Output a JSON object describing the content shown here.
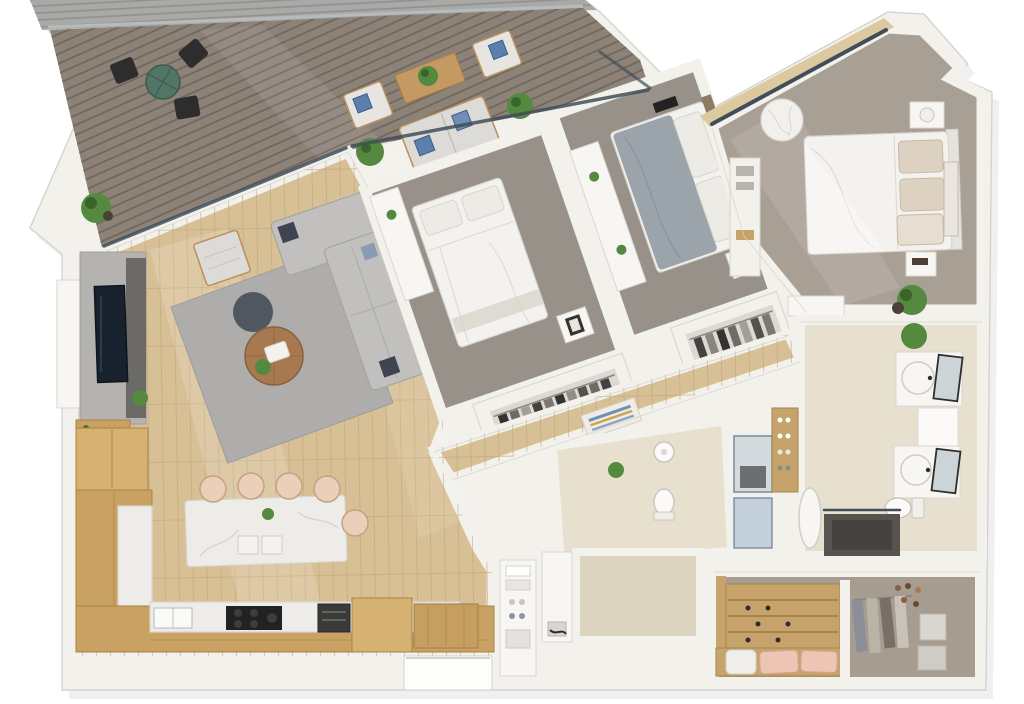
{
  "meta": {
    "kind": "3d-floor-plan-render",
    "view": "top-down dollhouse render of an apartment",
    "background": "#ffffff"
  },
  "colors": {
    "wall": "#f2f1ec",
    "wallEdge": "#d5d4cc",
    "shadow": "#000000",
    "roof": "#a9a9a7",
    "roofLine": "#8f8f8d",
    "deck": "#8d8278",
    "deckLine": "#6f655b",
    "deckRail": "#b6bcbe",
    "glass": "#414e59",
    "glassBlue": "#c3cfdb",
    "wood": "#d8c096",
    "woodLine": "#bfa276",
    "woodSill": "#dcc9a0",
    "cabinet": "#c9a263",
    "cabinetLine": "#a8833f",
    "cabinetLight": "#d5b272",
    "marble": "#edece8",
    "marbleVein": "#cfccc4",
    "stool": "#eccfb8",
    "stoolEdge": "#c5a184",
    "rug": "#aeadab",
    "pouf": "#515760",
    "sofa": "#c1c0be",
    "sofaEdge": "#a5a4a1",
    "tableWood": "#a87950",
    "chairWood": "#b98f5e",
    "carpetBed": "#98918a",
    "carpetMaster": "#a89f95",
    "bedWhite": "#f3f2ef",
    "bedEdge": "#d9d6cf",
    "blanketGray": "#9ba3ab",
    "pillowBeige": "#ddd2c2",
    "headboard": "#8d7a62",
    "tile": "#e8e0cf",
    "tileWall": "#ddd4bf",
    "showerFloor": "#45433f",
    "closetBg": "#a79c90",
    "closetWood": "#c6a36b",
    "pink": "#ecc5b5",
    "blanketWhite": "#f0eeea",
    "plant": "#55893f",
    "plantDark": "#39652c",
    "pot": "#4a4038",
    "tableGreen": "#527666",
    "dark": "#2d2d2d",
    "blue": "#5b7fae",
    "artTan": "#caa84a",
    "furnWhite": "#f7f6f3",
    "itemGray": "#b9b5ae"
  },
  "rooms": [
    {
      "id": "deck",
      "name": "Deck / Balcony",
      "floor": "gray wood decking",
      "furniture": [
        "round green dining table",
        "3 black outdoor chairs",
        "outdoor sofa with blue pillows",
        "2 outdoor armchairs with blue pillows",
        "wooden coffee table with plant",
        "2 potted plants"
      ]
    },
    {
      "id": "living-room",
      "name": "Living Room",
      "floor": "light oak planks",
      "furniture": [
        "L-shaped gray sofa",
        "armchair",
        "round wooden coffee table",
        "dark ottoman pouf",
        "gray area rug",
        "TV media wall",
        "bar shelf with bottles",
        "potted plant"
      ]
    },
    {
      "id": "kitchen",
      "name": "Kitchen",
      "floor": "light oak planks",
      "furniture": [
        "L-shaped oak cabinets",
        "marble island",
        "5 bar stools",
        "cooktop",
        "sink",
        "built-in oven",
        "wood entry platform"
      ]
    },
    {
      "id": "bedroom-1",
      "name": "Bedroom 1",
      "floor": "taupe carpet",
      "furniture": [
        "double bed",
        "open wardrobe with clothes",
        "nightstand with art",
        "dresser"
      ]
    },
    {
      "id": "bedroom-2",
      "name": "Bedroom 2",
      "floor": "taupe carpet",
      "furniture": [
        "double bed with gray blanket",
        "wood headboard",
        "open wardrobe with clothes",
        "desk",
        "nightstand with plant"
      ]
    },
    {
      "id": "master-bedroom",
      "name": "Master Bedroom",
      "floor": "taupe carpet",
      "furniture": [
        "king bed",
        "2 nightstands",
        "table lamp",
        "bean bag chair",
        "leaning artwork",
        "potted plant",
        "built-in shelving"
      ]
    },
    {
      "id": "master-bathroom",
      "name": "Master Bathroom",
      "floor": "beige tile",
      "furniture": [
        "double vanity with round sinks",
        "2 leaning mirrors",
        "toilet",
        "bathtub",
        "walk-in shower",
        "potted plant",
        "shoe shelf"
      ]
    },
    {
      "id": "guest-bathroom",
      "name": "Guest Bathroom",
      "floor": "beige tile",
      "furniture": [
        "pedestal sink",
        "toilet",
        "glass shower",
        "plant"
      ]
    },
    {
      "id": "laundry",
      "name": "Laundry / Linen",
      "floor": "white",
      "furniture": [
        "linen shelves with towels and shoes",
        "washer counter"
      ]
    },
    {
      "id": "walk-in-closet",
      "name": "Walk-in Closet",
      "floor": "gray-brown",
      "furniture": [
        "tiered shoe shelves",
        "bench with 2 pink pillows and white throw",
        "hanging clothes",
        "shoe rail",
        "2 storage baskets"
      ]
    },
    {
      "id": "hallway",
      "name": "Hallway",
      "floor": "light oak planks",
      "furniture": [
        "striped artwork on bench"
      ]
    },
    {
      "id": "entry",
      "name": "Entry",
      "floor": "white",
      "furniture": [
        "recessed doorway"
      ]
    }
  ]
}
